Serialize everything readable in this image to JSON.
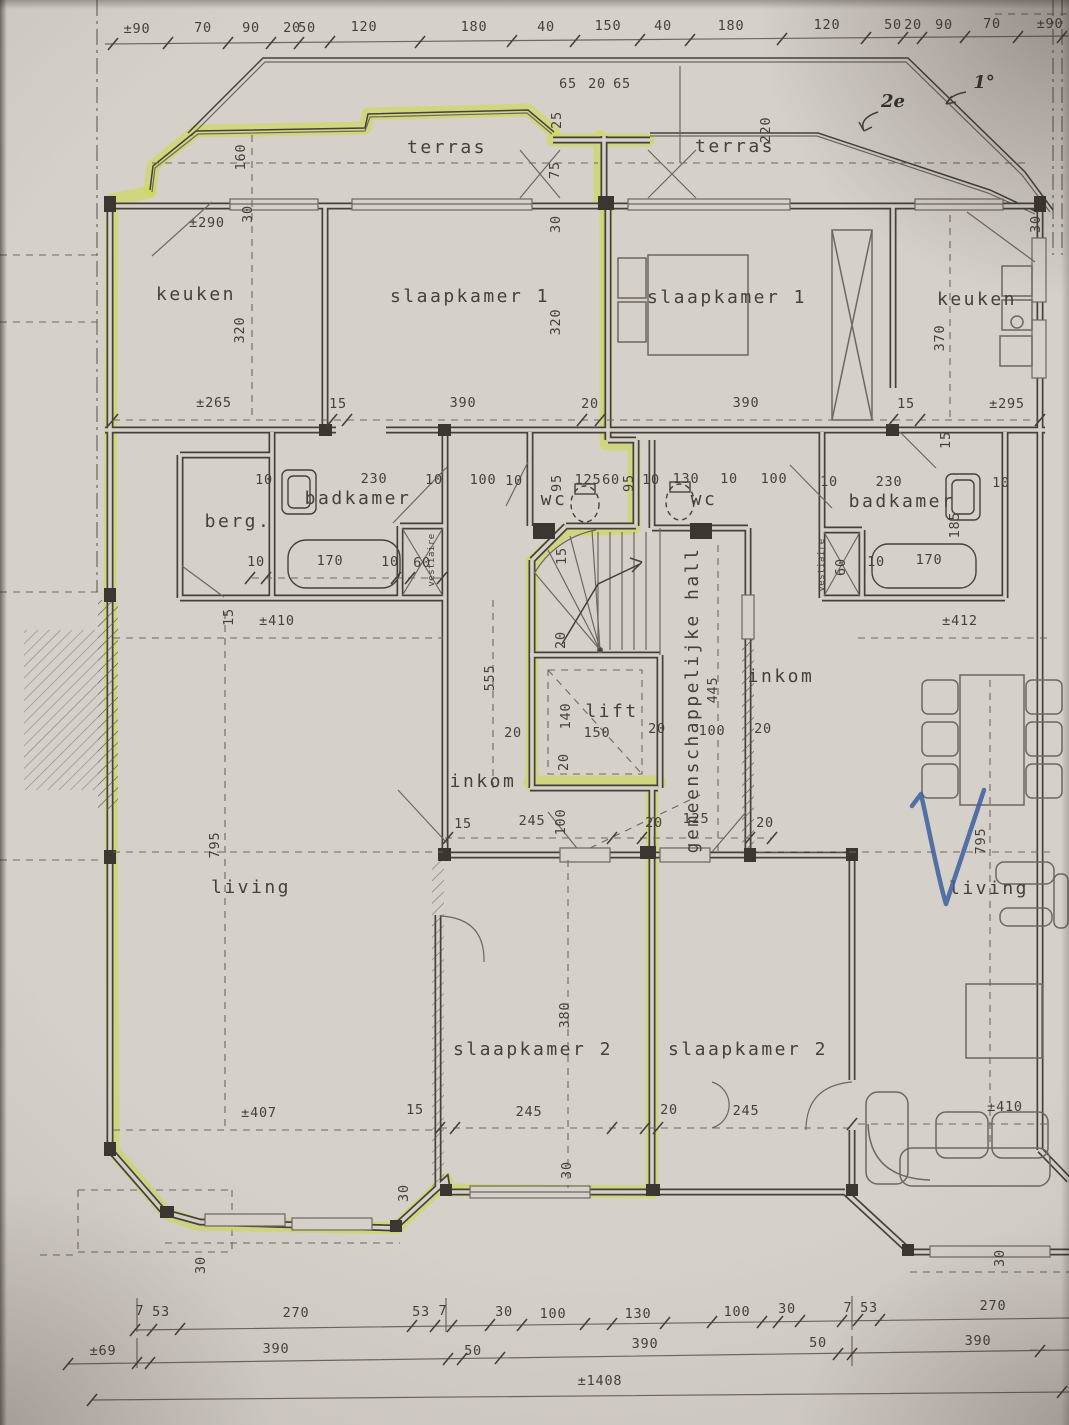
{
  "drawing": {
    "kind": "apartment floor plan scan with highlighter and pen marks",
    "highlighted_unit": "left apartment perimeter traced in yellow-green highlighter"
  },
  "colors": {
    "paper": "#d6d0cb",
    "ink": "#45403a",
    "faint_ink": "#6e675f",
    "highlighter": "#cdda52",
    "pen_blue": "#3c5f9f"
  },
  "room_labels": [
    {
      "t": "terras",
      "x": 447,
      "y": 153
    },
    {
      "t": "terras",
      "x": 735,
      "y": 152
    },
    {
      "t": "keuken",
      "x": 196,
      "y": 300
    },
    {
      "t": "slaapkamer 1",
      "x": 470,
      "y": 302
    },
    {
      "t": "slaapkamer 1",
      "x": 727,
      "y": 303
    },
    {
      "t": "keuken",
      "x": 977,
      "y": 305
    },
    {
      "t": "badkamer",
      "x": 358,
      "y": 504
    },
    {
      "t": "berg.",
      "x": 238,
      "y": 527
    },
    {
      "t": "wc",
      "x": 554,
      "y": 505
    },
    {
      "t": "wc",
      "x": 704,
      "y": 505
    },
    {
      "t": "badkamer",
      "x": 902,
      "y": 507
    },
    {
      "t": "vestiaire",
      "x": 434,
      "y": 560,
      "r": -90,
      "s": 1
    },
    {
      "t": "vestiaire",
      "x": 824,
      "y": 565,
      "r": -90,
      "s": 1
    },
    {
      "t": "lift",
      "x": 612,
      "y": 717
    },
    {
      "t": "gemeenschappelijke hall",
      "x": 698,
      "y": 700,
      "r": -90
    },
    {
      "t": "inkom",
      "x": 483,
      "y": 787
    },
    {
      "t": "inkom",
      "x": 781,
      "y": 682
    },
    {
      "t": "living",
      "x": 251,
      "y": 893
    },
    {
      "t": "living",
      "x": 989,
      "y": 894
    },
    {
      "t": "slaapkamer 2",
      "x": 533,
      "y": 1055
    },
    {
      "t": "slaapkamer 2",
      "x": 748,
      "y": 1055
    }
  ],
  "top_ruler": [
    {
      "t": "±90",
      "x": 137,
      "y": 33
    },
    {
      "t": "70",
      "x": 203,
      "y": 32
    },
    {
      "t": "90",
      "x": 251,
      "y": 32
    },
    {
      "t": "20",
      "x": 292,
      "y": 32
    },
    {
      "t": "50",
      "x": 307,
      "y": 32
    },
    {
      "t": "120",
      "x": 364,
      "y": 31
    },
    {
      "t": "180",
      "x": 474,
      "y": 31
    },
    {
      "t": "40",
      "x": 546,
      "y": 31
    },
    {
      "t": "150",
      "x": 608,
      "y": 30
    },
    {
      "t": "40",
      "x": 663,
      "y": 30
    },
    {
      "t": "180",
      "x": 731,
      "y": 30
    },
    {
      "t": "120",
      "x": 827,
      "y": 29
    },
    {
      "t": "50",
      "x": 893,
      "y": 29
    },
    {
      "t": "20",
      "x": 913,
      "y": 29
    },
    {
      "t": "90",
      "x": 944,
      "y": 29
    },
    {
      "t": "70",
      "x": 992,
      "y": 28
    },
    {
      "t": "±90",
      "x": 1050,
      "y": 28
    }
  ],
  "dim_labels": [
    {
      "t": "65",
      "x": 568,
      "y": 88
    },
    {
      "t": "20",
      "x": 597,
      "y": 88
    },
    {
      "t": "65",
      "x": 622,
      "y": 88
    },
    {
      "t": "25",
      "x": 561,
      "y": 120,
      "r": -90
    },
    {
      "t": "75",
      "x": 559,
      "y": 170,
      "r": -90
    },
    {
      "t": "160",
      "x": 245,
      "y": 157,
      "r": -90
    },
    {
      "t": "220",
      "x": 770,
      "y": 130,
      "r": -90
    },
    {
      "t": "±290",
      "x": 207,
      "y": 227
    },
    {
      "t": "320",
      "x": 244,
      "y": 330,
      "r": -90
    },
    {
      "t": "30",
      "x": 252,
      "y": 214,
      "r": -90
    },
    {
      "t": "320",
      "x": 560,
      "y": 322,
      "r": -90
    },
    {
      "t": "30",
      "x": 560,
      "y": 224,
      "r": -90
    },
    {
      "t": "370",
      "x": 944,
      "y": 338,
      "r": -90
    },
    {
      "t": "30",
      "x": 1040,
      "y": 224,
      "r": -90
    },
    {
      "t": "±265",
      "x": 214,
      "y": 407
    },
    {
      "t": "15",
      "x": 338,
      "y": 408
    },
    {
      "t": "390",
      "x": 463,
      "y": 407
    },
    {
      "t": "20",
      "x": 590,
      "y": 408
    },
    {
      "t": "390",
      "x": 746,
      "y": 407
    },
    {
      "t": "15",
      "x": 906,
      "y": 408
    },
    {
      "t": "±295",
      "x": 1007,
      "y": 408
    },
    {
      "t": "15",
      "x": 950,
      "y": 440,
      "r": -90
    },
    {
      "t": "10",
      "x": 264,
      "y": 484
    },
    {
      "t": "230",
      "x": 374,
      "y": 483
    },
    {
      "t": "10",
      "x": 434,
      "y": 484
    },
    {
      "t": "100",
      "x": 483,
      "y": 484
    },
    {
      "t": "10",
      "x": 514,
      "y": 485
    },
    {
      "t": "95",
      "x": 561,
      "y": 483,
      "r": -90
    },
    {
      "t": "125",
      "x": 588,
      "y": 484
    },
    {
      "t": "60",
      "x": 611,
      "y": 484
    },
    {
      "t": "95",
      "x": 633,
      "y": 483,
      "r": -90
    },
    {
      "t": "10",
      "x": 651,
      "y": 484
    },
    {
      "t": "130",
      "x": 686,
      "y": 483
    },
    {
      "t": "10",
      "x": 729,
      "y": 483
    },
    {
      "t": "100",
      "x": 774,
      "y": 483
    },
    {
      "t": "10",
      "x": 256,
      "y": 566
    },
    {
      "t": "170",
      "x": 330,
      "y": 565
    },
    {
      "t": "10",
      "x": 390,
      "y": 566
    },
    {
      "t": "60",
      "x": 422,
      "y": 567
    },
    {
      "t": "10",
      "x": 829,
      "y": 486
    },
    {
      "t": "230",
      "x": 889,
      "y": 486
    },
    {
      "t": "10",
      "x": 1001,
      "y": 487
    },
    {
      "t": "185",
      "x": 959,
      "y": 525,
      "r": -90
    },
    {
      "t": "10",
      "x": 876,
      "y": 566
    },
    {
      "t": "170",
      "x": 929,
      "y": 564
    },
    {
      "t": "60",
      "x": 845,
      "y": 567,
      "r": -90
    },
    {
      "t": "15",
      "x": 566,
      "y": 556,
      "r": -90
    },
    {
      "t": "20",
      "x": 565,
      "y": 640,
      "r": -90
    },
    {
      "t": "140",
      "x": 570,
      "y": 716,
      "r": -90
    },
    {
      "t": "150",
      "x": 597,
      "y": 737
    },
    {
      "t": "20",
      "x": 513,
      "y": 737
    },
    {
      "t": "20",
      "x": 568,
      "y": 762,
      "r": -90
    },
    {
      "t": "20",
      "x": 657,
      "y": 733
    },
    {
      "t": "445",
      "x": 717,
      "y": 690,
      "r": -90
    },
    {
      "t": "100",
      "x": 712,
      "y": 735
    },
    {
      "t": "20",
      "x": 763,
      "y": 733
    },
    {
      "t": "20",
      "x": 765,
      "y": 827
    },
    {
      "t": "555",
      "x": 494,
      "y": 678,
      "r": -90
    },
    {
      "t": "245",
      "x": 532,
      "y": 825
    },
    {
      "t": "100",
      "x": 565,
      "y": 822,
      "r": -90
    },
    {
      "t": "15",
      "x": 463,
      "y": 828
    },
    {
      "t": "20",
      "x": 654,
      "y": 827
    },
    {
      "t": "125",
      "x": 696,
      "y": 823
    },
    {
      "t": "±410",
      "x": 277,
      "y": 625
    },
    {
      "t": "15",
      "x": 233,
      "y": 617,
      "r": -90
    },
    {
      "t": "795",
      "x": 219,
      "y": 845,
      "r": -90
    },
    {
      "t": "±407",
      "x": 259,
      "y": 1117
    },
    {
      "t": "15",
      "x": 415,
      "y": 1114
    },
    {
      "t": "±412",
      "x": 960,
      "y": 625
    },
    {
      "t": "795",
      "x": 985,
      "y": 841,
      "r": -90
    },
    {
      "t": "±410",
      "x": 1005,
      "y": 1111
    },
    {
      "t": "380",
      "x": 569,
      "y": 1015,
      "r": -90
    },
    {
      "t": "245",
      "x": 529,
      "y": 1116
    },
    {
      "t": "20",
      "x": 669,
      "y": 1114
    },
    {
      "t": "30",
      "x": 571,
      "y": 1170,
      "r": -90
    },
    {
      "t": "245",
      "x": 746,
      "y": 1115
    },
    {
      "t": "30",
      "x": 408,
      "y": 1193,
      "r": -90
    },
    {
      "t": "30",
      "x": 205,
      "y": 1265,
      "r": -90
    },
    {
      "t": "30",
      "x": 1004,
      "y": 1258,
      "r": -90
    }
  ],
  "bottom_ruler": [
    {
      "t": "7",
      "x": 140,
      "y": 1315
    },
    {
      "t": "53",
      "x": 161,
      "y": 1316
    },
    {
      "t": "270",
      "x": 296,
      "y": 1317
    },
    {
      "t": "53",
      "x": 421,
      "y": 1316
    },
    {
      "t": "7",
      "x": 443,
      "y": 1315
    },
    {
      "t": "30",
      "x": 504,
      "y": 1316
    },
    {
      "t": "100",
      "x": 553,
      "y": 1318
    },
    {
      "t": "130",
      "x": 638,
      "y": 1318
    },
    {
      "t": "100",
      "x": 737,
      "y": 1316
    },
    {
      "t": "30",
      "x": 787,
      "y": 1313
    },
    {
      "t": "7",
      "x": 848,
      "y": 1312
    },
    {
      "t": "53",
      "x": 869,
      "y": 1312
    },
    {
      "t": "270",
      "x": 993,
      "y": 1310
    },
    {
      "t": "±69",
      "x": 103,
      "y": 1355
    },
    {
      "t": "390",
      "x": 276,
      "y": 1353
    },
    {
      "t": "50",
      "x": 473,
      "y": 1355
    },
    {
      "t": "390",
      "x": 645,
      "y": 1348
    },
    {
      "t": "50",
      "x": 818,
      "y": 1347
    },
    {
      "t": "390",
      "x": 978,
      "y": 1345
    },
    {
      "t": "±1408",
      "x": 600,
      "y": 1385
    }
  ],
  "handwritten": [
    {
      "t": "1°",
      "x": 984,
      "y": 88
    },
    {
      "t": "2e",
      "x": 893,
      "y": 107
    }
  ]
}
